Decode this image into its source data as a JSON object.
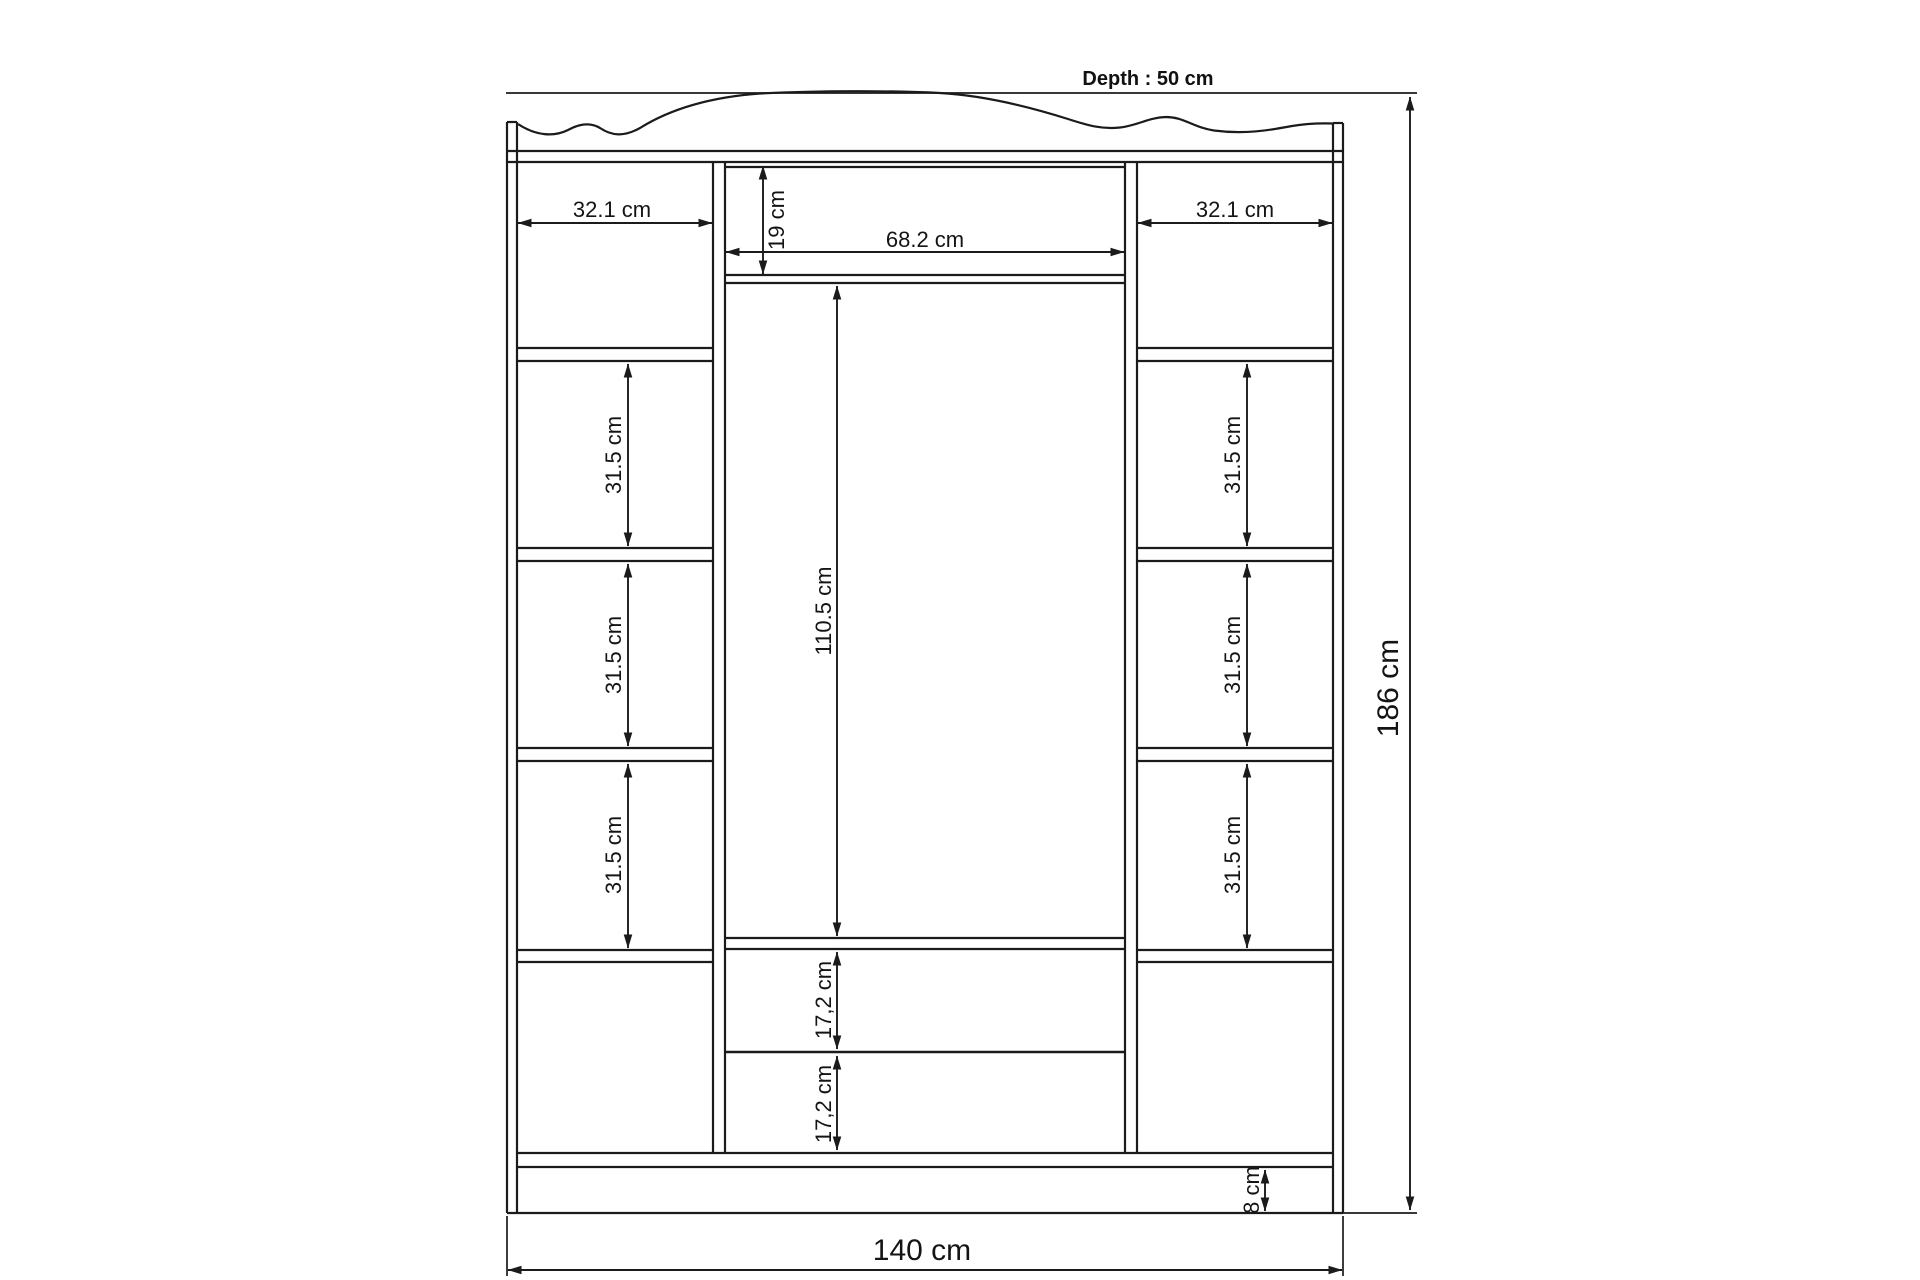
{
  "drawing": {
    "depth_note": "Depth : 50 cm",
    "overall": {
      "width": "140 cm",
      "height": "186 cm"
    },
    "left_column": {
      "width": "32.1 cm",
      "shelf_2": "31.5 cm",
      "shelf_3": "31.5 cm",
      "shelf_4": "31.5 cm"
    },
    "right_column": {
      "width": "32.1 cm",
      "shelf_2": "31.5 cm",
      "shelf_3": "31.5 cm",
      "shelf_4": "31.5 cm"
    },
    "center_section": {
      "width": "68.2 cm",
      "top_compartment_height": "19 cm",
      "door_height": "110.5 cm",
      "drawer_1": "17,2 cm",
      "drawer_2": "17,2 cm"
    },
    "base": {
      "height": "8 cm"
    }
  },
  "colors": {
    "line": "#1b1b1b",
    "text": "#141414",
    "background": "#ffffff"
  }
}
